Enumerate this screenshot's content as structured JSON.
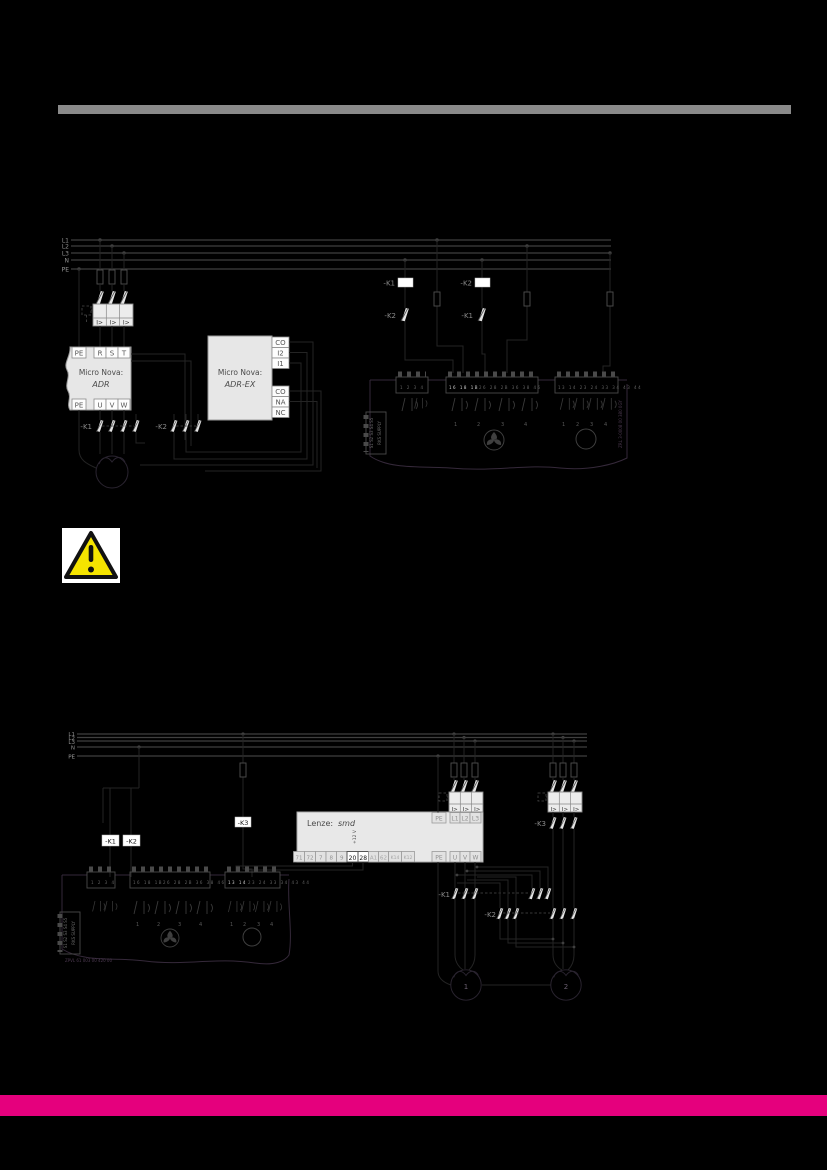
{
  "page": {
    "background": "#000000",
    "top_bar_color": "#8a8a8a",
    "bottom_bar_color": "#e5007d"
  },
  "d1": {
    "bus": [
      "L1",
      "L2",
      "L3",
      "N",
      "PE"
    ],
    "trip": "I>",
    "adr": {
      "brand": "Micro Nova:",
      "model": "ADR",
      "top": [
        "PE",
        "R",
        "S",
        "T"
      ],
      "bottom": [
        "PE",
        "U",
        "V",
        "W"
      ]
    },
    "adrex": {
      "brand": "Micro Nova:",
      "model": "ADR-EX",
      "relay": [
        "CO",
        "I2",
        "I1"
      ],
      "alarm": [
        "CO",
        "NA",
        "NC"
      ]
    },
    "k1_contacts": "-K1",
    "k2_contacts": "-K2",
    "k1_coil": "-K1",
    "k2_coil": "-K2",
    "k1_aux": "-K1",
    "k2_aux": "-K2",
    "part_number": "ZRL 3-0008 00 380 0GY"
  },
  "d2": {
    "bus": [
      "L1",
      "L2",
      "L3",
      "N",
      "PE"
    ],
    "trip": "I>",
    "k1_coil": "-K1",
    "k2_coil": "-K2",
    "k3_coil": "-K3",
    "k3_contacts": "-K3",
    "k1_contacts": "-K1",
    "k2_contacts": "-K2",
    "lenze": {
      "brand": "Lenze:",
      "model": "smd",
      "aux": "+12 V",
      "control": [
        "71",
        "72",
        "7",
        "8",
        "9",
        "20",
        "28",
        "A1",
        "62",
        "K14",
        "K12"
      ],
      "pe_in": "PE",
      "input": [
        "L1",
        "L2",
        "L3"
      ],
      "pe_out": "PE",
      "output": [
        "U",
        "V",
        "W"
      ]
    },
    "motors": [
      "1",
      "2"
    ],
    "part_number": "ZPVL 61 003 00 420 00"
  },
  "rks": {
    "supply": "RKS SUPPLY",
    "supply_terminals": "S1 S2 S3 S4 S5",
    "blockA": "1 2 3 4",
    "blockB_hi": "16 18 1B",
    "blockB": "26 28 2B 36 38 46",
    "blockC_full": "13 14 23 24 33 34 43 44",
    "blockC_hi": "13 14",
    "blockC": "23 24 33 34 43 44",
    "outputs": [
      "1",
      "2",
      "3",
      "4"
    ]
  }
}
